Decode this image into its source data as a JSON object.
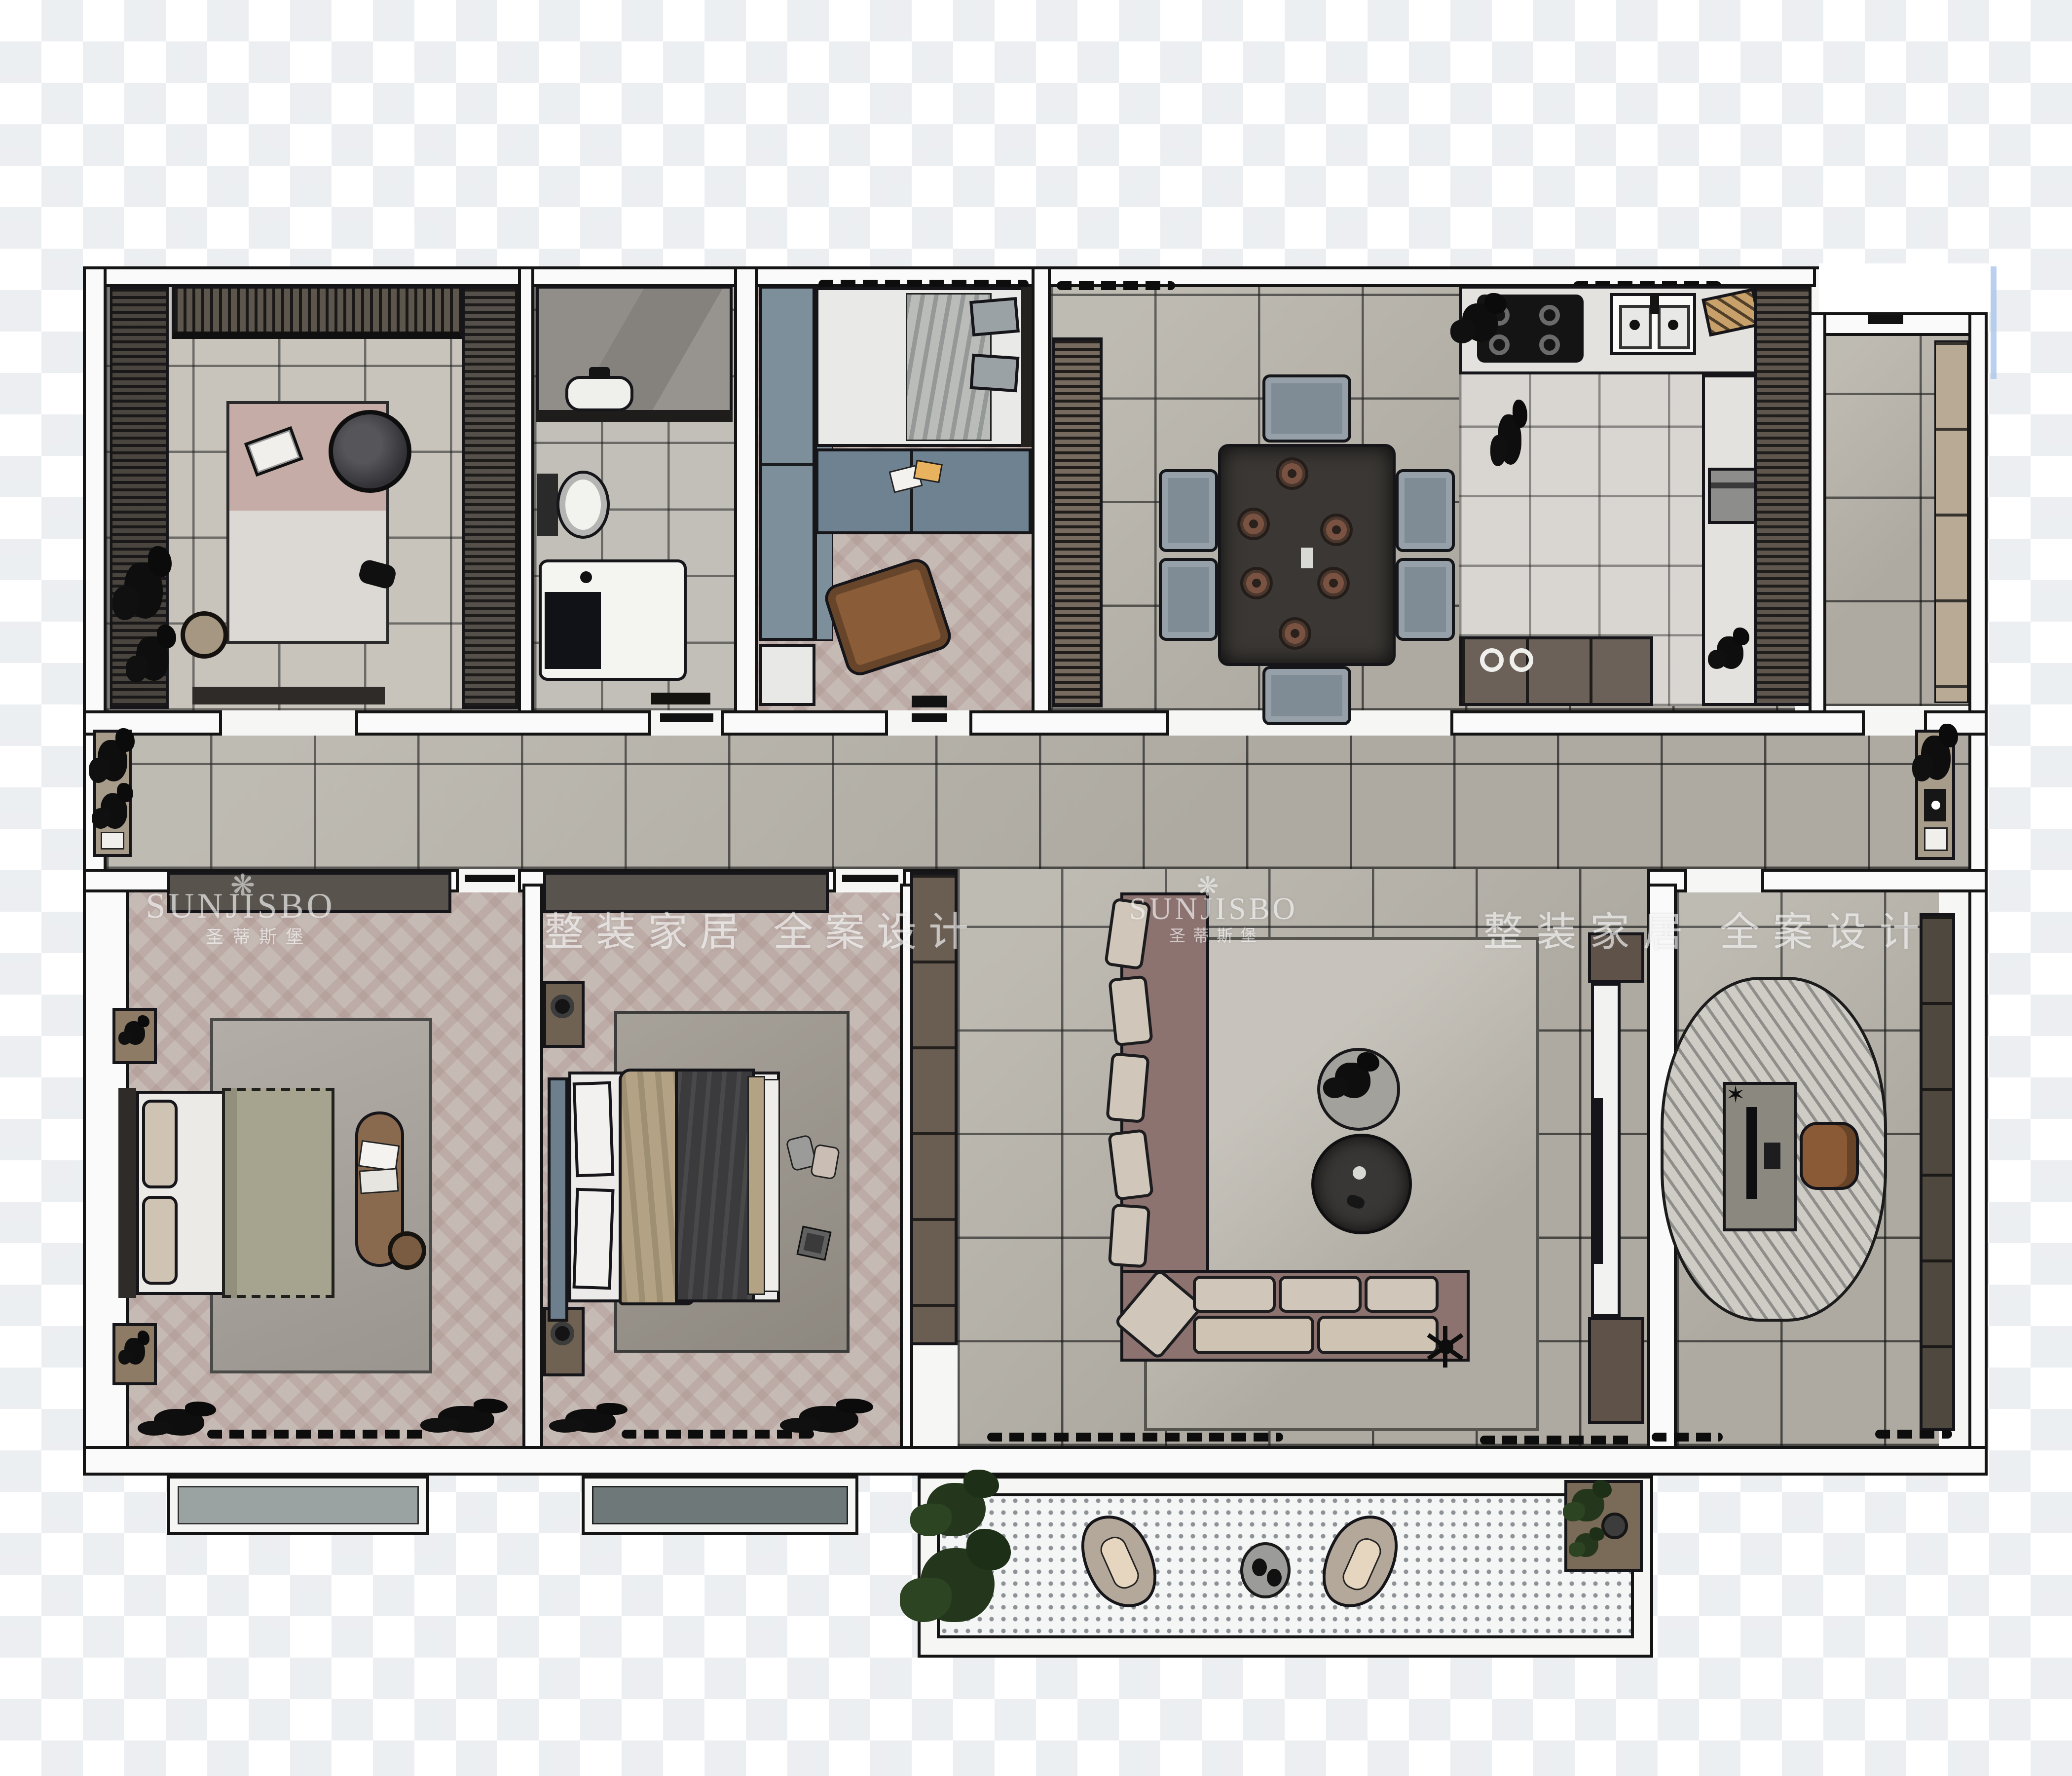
{
  "watermark": {
    "brand": "SUNJISBO",
    "brand_zh": "圣蒂斯堡",
    "slogan_zh": "整装家居 全案设计",
    "logo_icon": "petal-burst-icon",
    "text_color": "#ffffff"
  },
  "palette": {
    "background": "#ffffff",
    "grid_tint": "#d8dde2",
    "wall_fill": "#fafafa",
    "wall_outline": "#141414",
    "floor_tile_gray": "#b7b3aa",
    "floor_tile_light": "#d9d6d1",
    "floor_herringbone": "#c6bab4",
    "cabinet_dark_brown": "#5d564d",
    "cabinet_blue_gray": "#7e8f9c",
    "sofa_mauve": "#8d7370",
    "cushion_beige": "#d0c7ba",
    "coffee_table_dark": "#393735",
    "chair_wood_brown": "#8a5a36",
    "duvet_green": "#a6a48e",
    "duvet_charcoal": "#3b3b3d",
    "duvet_tan": "#b3a284",
    "balcony_dot": "#8d9296",
    "bay_window_slab_light": "#9aa2a2",
    "bay_window_slab_dark": "#6e7878"
  },
  "rooms": [
    {
      "name": "cloakroom",
      "furniture": [
        "wardrobe-run",
        "top-cabinets",
        "round-lounge-chair",
        "area-rug",
        "open-book",
        "slippers",
        "pouf",
        "potted-plant",
        "window-bench"
      ]
    },
    {
      "name": "bathroom",
      "furniture": [
        "stone-vanity",
        "sink",
        "toilet",
        "washer-shower-base"
      ]
    },
    {
      "name": "kids-bedroom",
      "furniture": [
        "wardrobe",
        "single-bed",
        "dresser-desk",
        "floor-mat"
      ]
    },
    {
      "name": "dining-room",
      "furniture": [
        "sideboard",
        "dining-table",
        "dining-chairs-x6",
        "place-settings-x6"
      ]
    },
    {
      "name": "kitchen",
      "furniture": [
        "gas-stove",
        "double-sink",
        "cutting-board",
        "tall-cabinet-run",
        "oven",
        "base-cabinets"
      ]
    },
    {
      "name": "pantry-utility",
      "furniture": [
        "shelf-run"
      ]
    },
    {
      "name": "hallway",
      "furniture": [
        "console-with-plant-left",
        "console-with-plant-right"
      ]
    },
    {
      "name": "bedroom",
      "furniture": [
        "double-bed",
        "nightstand-x2",
        "wardrobe-run",
        "area-rug",
        "upholstered-bench",
        "pouf",
        "bay-window"
      ]
    },
    {
      "name": "master-bedroom",
      "furniture": [
        "double-bed",
        "nightstand-x2",
        "wardrobe-run",
        "side-wardrobe",
        "area-rug",
        "slippers",
        "bay-window"
      ]
    },
    {
      "name": "living-room",
      "furniture": [
        "l-shaped-sofa",
        "round-coffee-table-x2",
        "area-rug",
        "floor-lamp",
        "tv-console",
        "media-cabinets"
      ]
    },
    {
      "name": "study",
      "furniture": [
        "oval-striped-rug",
        "desk",
        "monitor",
        "office-chair",
        "bookcase"
      ]
    },
    {
      "name": "balcony",
      "furniture": [
        "lounge-chair-x2",
        "round-side-table",
        "planter-x2",
        "plant-stand"
      ]
    }
  ]
}
